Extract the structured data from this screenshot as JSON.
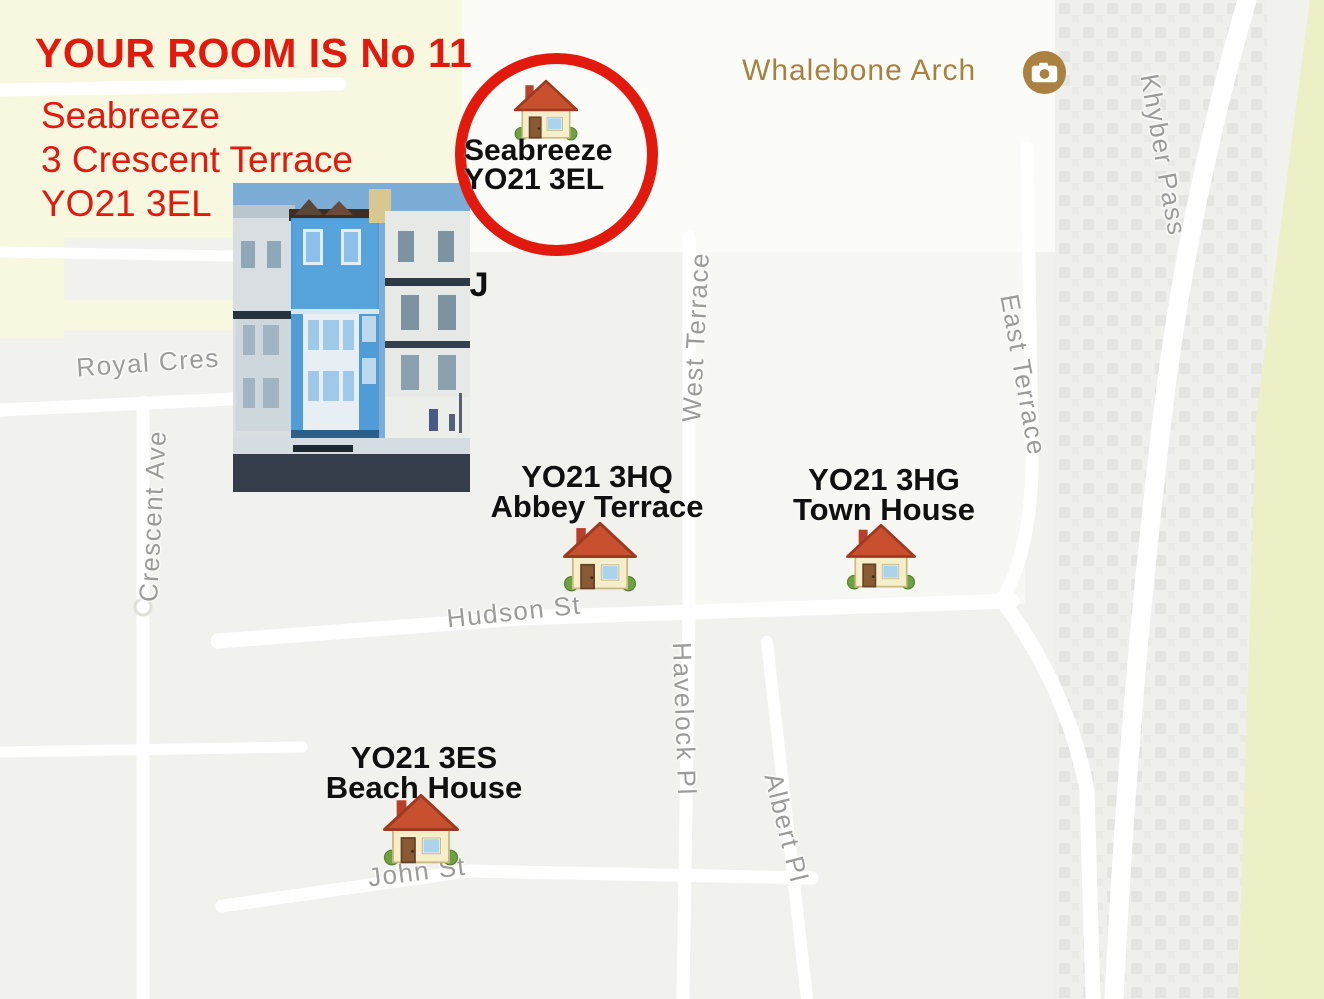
{
  "annotation": {
    "title": "YOUR ROOM IS No 11",
    "address": {
      "line1": "Seabreeze",
      "line2": "3 Crescent Terrace",
      "line3": "YO21 3EL"
    },
    "partial_text": "EJ",
    "highlight_marker": {
      "line1": "Seabreeze",
      "line2": "YO21 3EL"
    }
  },
  "markers": [
    {
      "postcode": "YO21 3HQ",
      "name": "Abbey Terrace"
    },
    {
      "postcode": "YO21 3HG",
      "name": "Town House"
    },
    {
      "postcode": "YO21 3ES",
      "name": "Beach House"
    }
  ],
  "poi": {
    "name": "Whalebone Arch",
    "icon": "camera-icon"
  },
  "streets": {
    "royal_cres": "Royal Cres",
    "crescent_ave": "Crescent Ave",
    "west_terrace": "West Terrace",
    "east_terrace": "East Terrace",
    "khyber_pass": "Khyber Pass",
    "hudson_st": "Hudson St",
    "havelock_pl": "Havelock Pl",
    "albert_pl": "Albert Pl",
    "john_st": "John St"
  },
  "icons": {
    "marker": "house-icon",
    "poi": "camera-icon"
  },
  "colors": {
    "annotation_red": "#e2190d",
    "poi_brown": "#a9813e",
    "street_gray": "#9b9b98",
    "label_black": "#101010",
    "map_yellow": "#f8f8e1",
    "beach_yellow": "#edefc7",
    "road_white": "#ffffff",
    "map_gray": "#f1f1ee"
  }
}
